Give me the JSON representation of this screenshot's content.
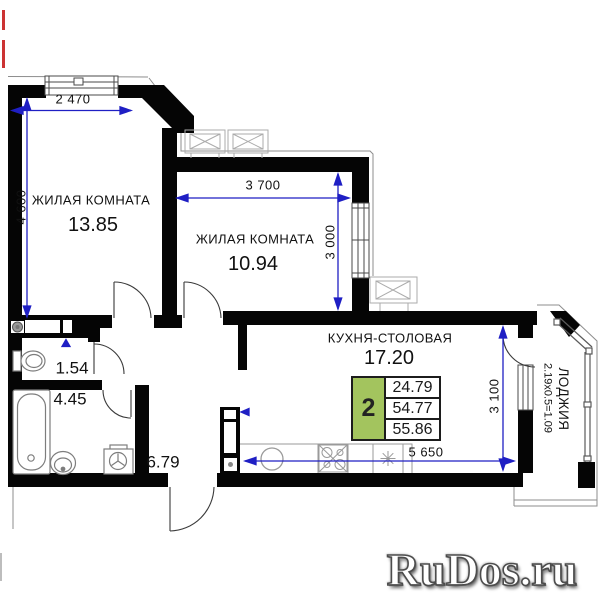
{
  "plan_title": "apartment floor plan",
  "rooms": {
    "living1": {
      "name": "ЖИЛАЯ КОМНАТА",
      "area": "13.85"
    },
    "living2": {
      "name": "ЖИЛАЯ КОМНАТА",
      "area": "10.94"
    },
    "kitchen": {
      "name": "КУХНЯ-СТОЛОВАЯ",
      "area": "17.20"
    },
    "wc": {
      "area": "1.54"
    },
    "bathroom": {
      "area": "4.45"
    },
    "hallway": {
      "area": "6.79"
    },
    "loggia": {
      "name": "ЛОДЖИЯ",
      "calc": "2.19x0.5=1.09"
    }
  },
  "dimensions": {
    "room1_width": "2 470",
    "room1_height": "4 600",
    "room2_width": "3 700",
    "room2_height": "3 000",
    "kitchen_width": "5 650",
    "kitchen_height": "3 100"
  },
  "summary_box": {
    "rooms_count": "2",
    "living_area": "24.79",
    "area_without_loggia": "54.77",
    "total_area": "55.86"
  },
  "watermark": {
    "text": "RuDos.ru"
  },
  "colors": {
    "wall": "#050505",
    "dimension_blue": "#1f1fc4",
    "summary_green": "#a3c45e",
    "fixture_gray": "#8a8a8a",
    "vent_gray": "#aaaaaa",
    "edge_mark_red": "#cc3333"
  },
  "icons": {
    "fixtures": [
      "bathtub",
      "bathroom-sink",
      "washing-machine",
      "toilet",
      "kitchen-sink",
      "stove",
      "fridge",
      "vent-grille",
      "vent-shaft"
    ]
  }
}
